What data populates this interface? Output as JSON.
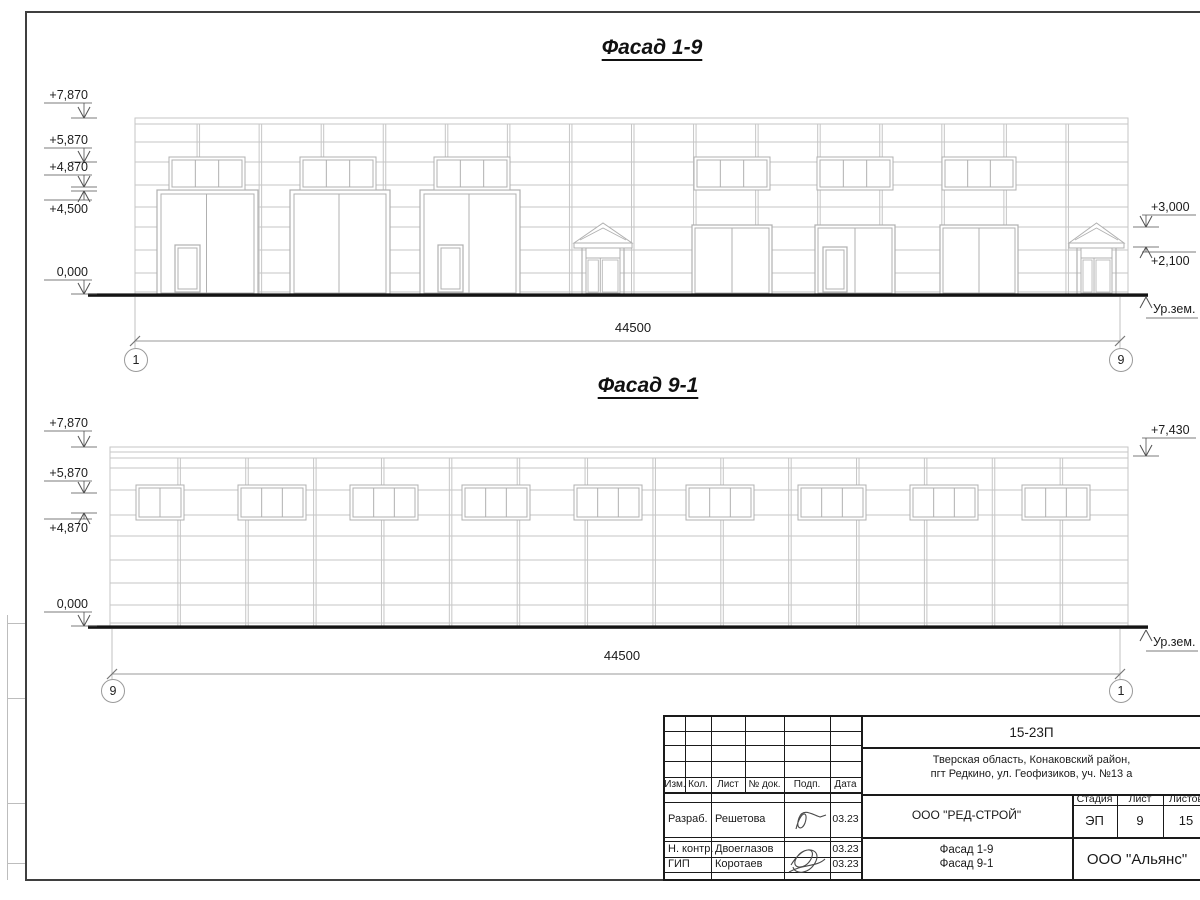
{
  "sheet": {
    "kind": "architectural drawing sheet"
  },
  "drawing": {
    "f1": {
      "title": "Фасад 1-9",
      "title_cx": 652,
      "title_top": 36,
      "left": 135,
      "right": 1128,
      "top": 118,
      "bottom": 294,
      "parapet": [
        124
      ],
      "vtop": 124,
      "vjoints": 15,
      "hlines": [
        142,
        162,
        185,
        207,
        227,
        250,
        273,
        292
      ],
      "win_y": 160,
      "win_h": 27,
      "windows": [
        {
          "x": 172,
          "w": 70,
          "panes": 3
        },
        {
          "x": 303,
          "w": 70,
          "panes": 3
        },
        {
          "x": 437,
          "w": 70,
          "panes": 3
        },
        {
          "x": 697,
          "w": 70,
          "panes": 3
        },
        {
          "x": 820,
          "w": 70,
          "panes": 3
        },
        {
          "x": 945,
          "w": 68,
          "panes": 3
        }
      ],
      "gate_y": 190,
      "wick_y": 245,
      "gates": [
        {
          "x": 157,
          "w": 101,
          "wicket": true
        },
        {
          "x": 290,
          "w": 100
        },
        {
          "x": 420,
          "w": 100,
          "wicket": true
        }
      ],
      "open_y": 225,
      "openings": [
        {
          "x": 692,
          "w": 80
        },
        {
          "x": 815,
          "w": 80,
          "wicket": true
        },
        {
          "x": 940,
          "w": 78
        }
      ],
      "porches": [
        {
          "x": 578,
          "w": 50
        },
        {
          "x": 1073,
          "w": 47
        }
      ],
      "ground_x1": 88,
      "ground_x2": 1148,
      "dim_y": 341,
      "dim_x1": 135,
      "dim_x2": 1120,
      "dim_text": "44500",
      "dim_cx": 633,
      "dim_top": 320,
      "axes": [
        {
          "x": 135,
          "label": "1"
        },
        {
          "x": 1120,
          "label": "9"
        }
      ],
      "axis_cy": 359,
      "marks": [
        {
          "text": "+7,870",
          "side": "L",
          "shelf_y": 103,
          "tip_y": 118,
          "dir": "down"
        },
        {
          "text": "+5,870",
          "side": "L",
          "shelf_y": 148,
          "tip_y": 162,
          "dir": "down"
        },
        {
          "text": "+4,870",
          "side": "L",
          "shelf_y": 175,
          "tip_y": 187,
          "dir": "down"
        },
        {
          "text": "+4,500",
          "side": "L",
          "shelf_y": 200,
          "tip_y": 191,
          "dir": "up"
        },
        {
          "text": "0,000",
          "side": "L",
          "shelf_y": 280,
          "tip_y": 294,
          "dir": "down"
        },
        {
          "text": "+3,000",
          "side": "R",
          "shelf_y": 215,
          "tip_y": 227,
          "dir": "down"
        },
        {
          "text": "+2,100",
          "side": "R",
          "shelf_y": 252,
          "tip_y": 247,
          "dir": "up"
        }
      ],
      "ground_mark": {
        "text": "Ур.зем.",
        "x": 1146,
        "y": 297
      }
    },
    "f2": {
      "title": "Фасад 9-1",
      "title_cx": 648,
      "title_top": 374,
      "left": 110,
      "right": 1128,
      "top": 447,
      "bottom": 626,
      "parapet": [
        452,
        458
      ],
      "vtop": 458,
      "vjoints": 14,
      "hlines": [
        468,
        490,
        515,
        536,
        560,
        583,
        605,
        623
      ],
      "win_y": 488,
      "win_h": 29,
      "windows": [
        {
          "x": 139,
          "w": 42,
          "panes": 2
        },
        {
          "x": 241,
          "w": 62,
          "panes": 3
        },
        {
          "x": 353,
          "w": 62,
          "panes": 3
        },
        {
          "x": 465,
          "w": 62,
          "panes": 3
        },
        {
          "x": 577,
          "w": 62,
          "panes": 3
        },
        {
          "x": 689,
          "w": 62,
          "panes": 3
        },
        {
          "x": 801,
          "w": 62,
          "panes": 3
        },
        {
          "x": 913,
          "w": 62,
          "panes": 3
        },
        {
          "x": 1025,
          "w": 62,
          "panes": 3
        }
      ],
      "gates": [],
      "openings": [],
      "porches": [],
      "ground_x1": 88,
      "ground_x2": 1148,
      "dim_y": 674,
      "dim_x1": 112,
      "dim_x2": 1120,
      "dim_text": "44500",
      "dim_cx": 622,
      "dim_top": 648,
      "axes": [
        {
          "x": 112,
          "label": "9"
        },
        {
          "x": 1120,
          "label": "1"
        }
      ],
      "axis_cy": 690,
      "marks": [
        {
          "text": "+7,870",
          "side": "L",
          "shelf_y": 431,
          "tip_y": 447,
          "dir": "down"
        },
        {
          "text": "+5,870",
          "side": "L",
          "shelf_y": 481,
          "tip_y": 493,
          "dir": "down"
        },
        {
          "text": "+4,870",
          "side": "L",
          "shelf_y": 519,
          "tip_y": 513,
          "dir": "up"
        },
        {
          "text": "0,000",
          "side": "L",
          "shelf_y": 612,
          "tip_y": 626,
          "dir": "down"
        },
        {
          "text": "+7,430",
          "side": "R",
          "shelf_y": 438,
          "tip_y": 456,
          "dir": "down"
        }
      ],
      "ground_mark": {
        "text": "Ур.зем.",
        "x": 1146,
        "y": 630
      }
    }
  },
  "title_block": {
    "doc_number": "15-23П",
    "address_line1": "Тверская область, Конаковский район,",
    "address_line2": "пгт Редкино, ул. Геофизиков, уч. №13 а",
    "columns": [
      "Изм.",
      "Кол.",
      "Лист",
      "№ док.",
      "Подп.",
      "Дата"
    ],
    "rows": [
      {
        "role": "Разраб.",
        "name": "Решетова",
        "date": "03.23"
      },
      {
        "role": "Н. контр.",
        "name": "Двоеглазов",
        "date": "03.23"
      },
      {
        "role": "ГИП",
        "name": "Коротаев",
        "date": "03.23"
      }
    ],
    "company": "ООО \"РЕД-СТРОЙ\"",
    "stage_label": "Стадия",
    "sheet_label": "Лист",
    "sheets_label": "Листов",
    "stage": "ЭП",
    "sheet": "9",
    "sheets": "15",
    "content_line1": "Фасад 1-9",
    "content_line2": "Фасад 9-1",
    "org": "ООО \"Альянс\""
  }
}
